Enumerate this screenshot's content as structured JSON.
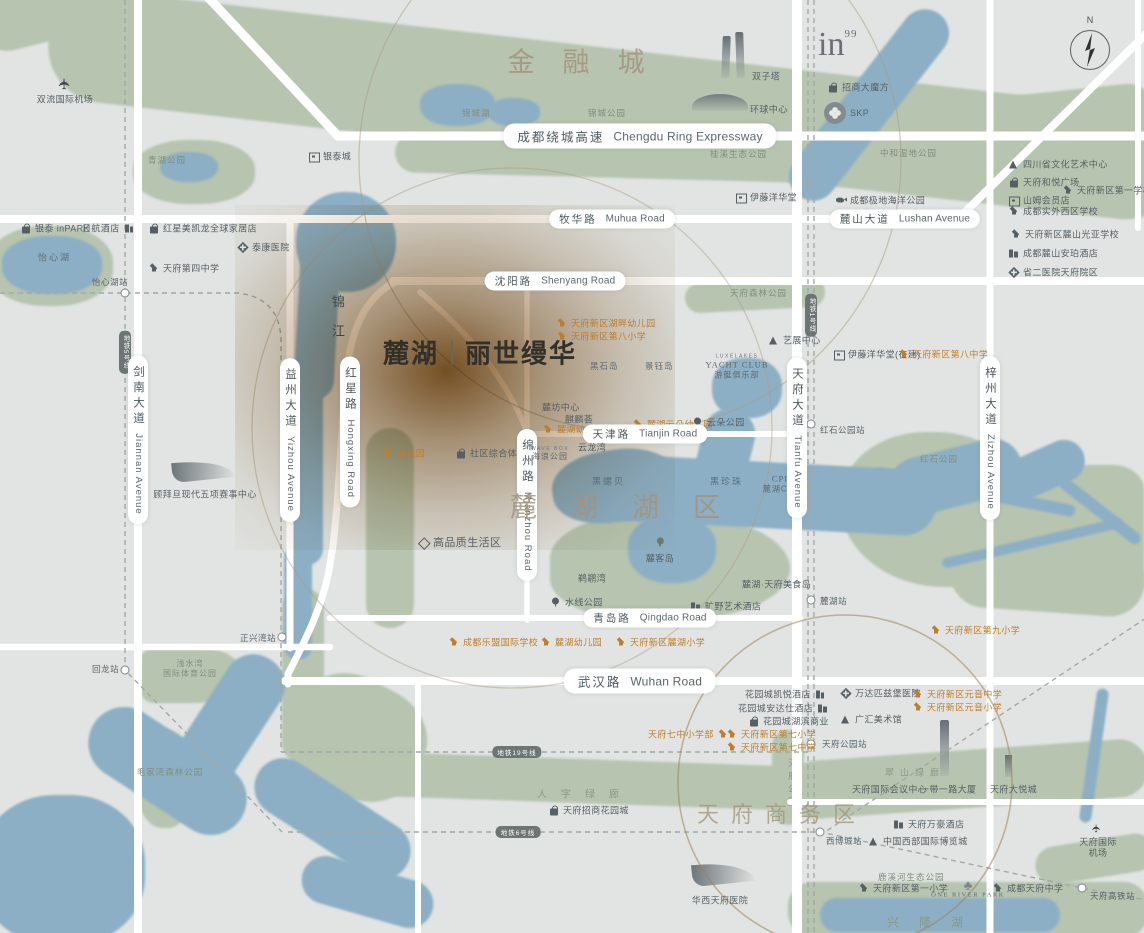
{
  "meta": {
    "description": "Stylized real-estate location map of Chengdu Tianfu New Area around LUXELAKES",
    "compass_n": "N",
    "colors": {
      "background": "#e1e4e2",
      "park_green": "#b6c4b0",
      "water_blue": "#8cafc5",
      "road_white": "#ffffff",
      "poi_gray": "#565f64",
      "poi_orange": "#bf7e2d",
      "title_brown": "#a5937e",
      "project_glow": "#7a4a1a"
    },
    "logos": {
      "in99": "in",
      "in99_sup": "99",
      "skp": "SKP"
    }
  },
  "project": {
    "name_left": "麓湖",
    "name_right": "丽世缦华"
  },
  "map": {
    "stations": [
      {
        "n": "station-yixinhu",
        "x": 125,
        "y": 293
      },
      {
        "n": "station-huilong",
        "x": 125,
        "y": 670
      },
      {
        "n": "station-zhengxingwan",
        "x": 282,
        "y": 637
      },
      {
        "n": "station-hongshipark",
        "x": 811,
        "y": 424
      },
      {
        "n": "station-luhu",
        "x": 811,
        "y": 600
      },
      {
        "n": "station-tianfupark",
        "x": 811,
        "y": 744
      },
      {
        "n": "station-xibocheng",
        "x": 820,
        "y": 832
      },
      {
        "n": "station-tianfu-hsr",
        "x": 1082,
        "y": 888
      }
    ],
    "labels": [
      {
        "n": "airport-shuangliu",
        "tp": "airport",
        "t": "双流国际机场",
        "x": 65,
        "y": 90
      },
      {
        "n": "park-qinghu",
        "tp": "park",
        "t": "青湖公园",
        "x": 148,
        "y": 160
      },
      {
        "n": "poi-yintai-city",
        "tp": "poi",
        "ic": "st",
        "t": "银泰城",
        "x": 308,
        "y": 156
      },
      {
        "n": "poi-yintai-inpark",
        "tp": "poi",
        "ic": "b",
        "t": "银泰 inPARK",
        "x": 20,
        "y": 228
      },
      {
        "n": "poi-hotel-nikko",
        "tp": "poi",
        "ic": "h",
        "ir": true,
        "t": "日航酒店",
        "x": 82,
        "y": 228
      },
      {
        "n": "poi-redstar-macalline",
        "tp": "poi",
        "ic": "b",
        "t": "红星美凯龙全球家居店",
        "x": 148,
        "y": 228
      },
      {
        "n": "poi-taikang-hospital",
        "tp": "poi",
        "ic": "c",
        "t": "泰康医院",
        "x": 237,
        "y": 247
      },
      {
        "n": "poi-tianfu-no4-school",
        "tp": "poi",
        "ic": "s",
        "t": "天府第四中学",
        "x": 148,
        "y": 268
      },
      {
        "n": "lake-yixinhu",
        "tp": "water",
        "t": "怡心湖",
        "x": 38,
        "y": 257
      },
      {
        "n": "stnl-yixinhu",
        "tp": "stn-l",
        "t": "怡心湖站",
        "x": 92,
        "y": 282
      },
      {
        "n": "district-financial-city",
        "tp": "title",
        "ctr": true,
        "sp": 28,
        "t": "金融城",
        "x": 590,
        "y": 60
      },
      {
        "n": "lake-jincheng",
        "tp": "park",
        "t": "锦城湖",
        "x": 462,
        "y": 113
      },
      {
        "n": "park-jincheng",
        "tp": "park",
        "t": "锦城公园",
        "x": 588,
        "y": 113
      },
      {
        "n": "poi-twin-towers",
        "tp": "poi",
        "t": "双子塔",
        "x": 752,
        "y": 76
      },
      {
        "n": "poi-global-center",
        "tp": "poi",
        "t": "环球中心",
        "x": 750,
        "y": 109
      },
      {
        "n": "road-ring-expressway",
        "tp": "pill-big",
        "ctr": true,
        "t": "成都绕城高速",
        "en": "Chengdu Ring Expressway",
        "x": 640,
        "y": 136
      },
      {
        "n": "park-guixi",
        "tp": "park",
        "t": "桂溪生态公园",
        "x": 710,
        "y": 154
      },
      {
        "n": "poi-ito-yokado",
        "tp": "poi",
        "ic": "st",
        "t": "伊藤洋华堂",
        "x": 735,
        "y": 197
      },
      {
        "n": "road-muhua",
        "tp": "pill",
        "ctr": true,
        "t": "牧华路",
        "en": "Muhua Road",
        "x": 612,
        "y": 219
      },
      {
        "n": "poi-cm-cube",
        "tp": "poi",
        "ic": "b",
        "t": "招商大魔方",
        "x": 827,
        "y": 87
      },
      {
        "n": "poi-skp",
        "tp": "poi",
        "t": "SKP",
        "x": 850,
        "y": 113
      },
      {
        "n": "park-zhonghe-wetland",
        "tp": "park",
        "t": "中和湿地公园",
        "x": 880,
        "y": 153
      },
      {
        "n": "poi-polar-ocean-park",
        "tp": "poi",
        "ic": "w",
        "t": "成都极地海洋公园",
        "x": 835,
        "y": 200
      },
      {
        "n": "road-lushan-ave",
        "tp": "pill",
        "ctr": true,
        "t": "麓山大道",
        "en": "Lushan Avenue",
        "x": 905,
        "y": 219
      },
      {
        "n": "poi-sichuan-art-center",
        "tp": "poi",
        "ic": "t",
        "t": "四川省文化艺术中心",
        "x": 1008,
        "y": 164
      },
      {
        "n": "poi-heyue-plaza",
        "tp": "poi",
        "ic": "b",
        "t": "天府和悦广场",
        "x": 1008,
        "y": 182
      },
      {
        "n": "poi-tianfu-no1-school",
        "tp": "poi",
        "ic": "s",
        "t": "天府新区第一学校",
        "x": 1062,
        "y": 190
      },
      {
        "n": "poi-sams-club",
        "tp": "poi",
        "ic": "st",
        "t": "山姆会员店",
        "x": 1008,
        "y": 200
      },
      {
        "n": "poi-shiwai-school",
        "tp": "poi",
        "ic": "s",
        "t": "成都实外西区学校",
        "x": 1008,
        "y": 211
      },
      {
        "n": "poi-guangya-school",
        "tp": "poi",
        "ic": "s",
        "t": "天府新区麓山光亚学校",
        "x": 1010,
        "y": 234
      },
      {
        "n": "poi-amber-hotel",
        "tp": "poi",
        "ic": "h",
        "t": "成都麓山安珀酒店",
        "x": 1008,
        "y": 253
      },
      {
        "n": "poi-prov-no2-hospital",
        "tp": "poi",
        "ic": "c",
        "t": "省二医院天府院区",
        "x": 1008,
        "y": 272
      },
      {
        "n": "road-shenyang",
        "tp": "pill",
        "ctr": true,
        "t": "沈阳路",
        "en": "Shenyang Road",
        "x": 555,
        "y": 281
      },
      {
        "n": "river-jinjiang",
        "tp": "water-v",
        "t": "锦江",
        "x": 328,
        "y": 295
      },
      {
        "n": "road-hongxing",
        "tp": "pill-v",
        "t": "红星路",
        "en": "Hongxing Road",
        "x": 350,
        "y": 432
      },
      {
        "n": "road-mianzhou",
        "tp": "pill-v",
        "t": "绵州路",
        "en": "Mianzhou Road",
        "x": 527,
        "y": 505
      },
      {
        "n": "poi-hupan-kindergarten",
        "tp": "poi-o",
        "ic": "s",
        "t": "天府新区湖畔幼儿园",
        "x": 556,
        "y": 323
      },
      {
        "n": "poi-no8-primary",
        "tp": "poi-o",
        "ic": "s",
        "t": "天府新区第八小学",
        "x": 556,
        "y": 336
      },
      {
        "n": "island-heishi",
        "tp": "island",
        "t": "黑石岛",
        "x": 590,
        "y": 366
      },
      {
        "n": "island-jingyu",
        "tp": "island",
        "t": "景钰岛",
        "x": 645,
        "y": 366
      },
      {
        "n": "blk-yacht-club",
        "tp": "blk",
        "lines": [
          [
            "l1",
            "LUXELAKES"
          ],
          [
            "l2",
            "YACHT CLUB"
          ],
          [
            "l3",
            "游艇俱乐部"
          ]
        ],
        "x": 737,
        "y": 367
      },
      {
        "n": "poi-art-expo-center",
        "tp": "poi",
        "ic": "t",
        "t": "艺展中心",
        "x": 768,
        "y": 340
      },
      {
        "n": "park-tianfu-forest",
        "tp": "park",
        "t": "天府森林公园",
        "x": 730,
        "y": 293
      },
      {
        "n": "poi-ito-yokado-uc",
        "tp": "poi",
        "ic": "st",
        "t": "伊藤洋华堂(在建)",
        "x": 833,
        "y": 354
      },
      {
        "n": "poi-no8-middle",
        "tp": "poi-o",
        "ic": "s",
        "t": "天府新区第八中学",
        "x": 898,
        "y": 354
      },
      {
        "n": "poi-lufang-center",
        "tp": "poi",
        "t": "麓坊中心",
        "x": 542,
        "y": 407
      },
      {
        "n": "poi-qilinhui",
        "tp": "poi",
        "t": "麒麟荟",
        "x": 565,
        "y": 419
      },
      {
        "n": "poi-yunduo-kindergarten",
        "tp": "poi-o",
        "ic": "s",
        "t": "麓湖云朵幼儿园",
        "x": 632,
        "y": 424
      },
      {
        "n": "poi-yunduo-park",
        "tp": "poi",
        "ic": "tr",
        "t": "云朵公园",
        "x": 692,
        "y": 422
      },
      {
        "n": "poi-luhu-kindergarten-n",
        "tp": "poi-o",
        "ic": "s",
        "t": "麓湖幼儿园(北区)",
        "x": 542,
        "y": 429
      },
      {
        "n": "road-tianjin",
        "tp": "pill",
        "ctr": true,
        "t": "天津路",
        "en": "Tianjin Road",
        "x": 645,
        "y": 434
      },
      {
        "n": "blk-wave-box",
        "tp": "blk",
        "lines": [
          [
            "l1",
            "WAVE BOX"
          ],
          [
            "l3",
            "海浪公园"
          ]
        ],
        "x": 550,
        "y": 454
      },
      {
        "n": "poi-yunlongwan",
        "tp": "poi",
        "t": "云龙湾",
        "x": 578,
        "y": 447
      },
      {
        "n": "poi-kindergarten-w",
        "tp": "poi-o",
        "ic": "s",
        "t": "幼儿园",
        "x": 382,
        "y": 453
      },
      {
        "n": "poi-community-complex",
        "tp": "poi",
        "ic": "b",
        "t": "社区综合体",
        "x": 455,
        "y": 453
      },
      {
        "n": "poi-quality-life-zone",
        "tp": "poi",
        "ic": "d",
        "fs": 11,
        "t": "高品质生活区",
        "x": 418,
        "y": 542
      },
      {
        "n": "district-luhu-lake",
        "tp": "title",
        "ctr": true,
        "sp": 34,
        "t": "麓湖湖区",
        "x": 632,
        "y": 505
      },
      {
        "n": "water-heiluobei",
        "tp": "water",
        "t": "黑螺贝",
        "x": 592,
        "y": 481
      },
      {
        "n": "water-heizhenzhu",
        "tp": "water",
        "t": "黑珍珠",
        "x": 710,
        "y": 481
      },
      {
        "n": "blk-cpi",
        "tp": "blk",
        "lines": [
          [
            "l2",
            "CPI"
          ],
          [
            "l3",
            "麓湖CPI"
          ]
        ],
        "x": 780,
        "y": 484
      },
      {
        "n": "blk-luke-island",
        "tp": "isle",
        "t": "麓客岛",
        "x": 660,
        "y": 549
      },
      {
        "n": "poi-tihuwan",
        "tp": "poi",
        "t": "鹈鹕湾",
        "x": 578,
        "y": 578
      },
      {
        "n": "poi-food-island",
        "tp": "poi",
        "t": "麓湖·天府美食岛",
        "x": 742,
        "y": 584
      },
      {
        "n": "poi-waterline-park",
        "tp": "poi",
        "ic": "tr",
        "t": "水线公园",
        "x": 550,
        "y": 602
      },
      {
        "n": "poi-kuangye-art-hotel",
        "tp": "poi",
        "ic": "h",
        "t": "旷野艺术酒店",
        "x": 690,
        "y": 606
      },
      {
        "n": "road-qingdao",
        "tp": "pill",
        "ctr": true,
        "t": "青岛路",
        "en": "Qingdao Road",
        "x": 650,
        "y": 618
      },
      {
        "n": "stnl-hongshipark",
        "tp": "stn-l",
        "t": "红石公园站",
        "x": 820,
        "y": 430
      },
      {
        "n": "park-hongshi",
        "tp": "park",
        "t": "红石公园",
        "x": 920,
        "y": 459
      },
      {
        "n": "road-tianfu-ave",
        "tp": "pill-v",
        "t": "天府大道",
        "en": "Tianfu Avenue",
        "x": 797,
        "y": 438
      },
      {
        "n": "road-zizhou-ave",
        "tp": "pill-v",
        "t": "梓州大道",
        "en": "Zizhou Avenue",
        "x": 990,
        "y": 438
      },
      {
        "n": "road-jiannan-ave",
        "tp": "pill-v",
        "t": "剑南大道",
        "en": "Jiannan Avenue",
        "x": 138,
        "y": 440
      },
      {
        "n": "road-yizhou-ave",
        "tp": "pill-v",
        "t": "益州大道",
        "en": "Yizhou Avenue",
        "x": 290,
        "y": 440
      },
      {
        "n": "venue-gubaidan",
        "tp": "venue",
        "t": "顾拜旦现代五项赛事中心",
        "x": 205,
        "y": 487
      },
      {
        "n": "stnl-zhengxingwan",
        "tp": "stn-l",
        "t": "正兴湾站",
        "x": 240,
        "y": 638
      },
      {
        "n": "stnl-huilong",
        "tp": "stn-l",
        "t": "回龙站",
        "x": 92,
        "y": 669
      },
      {
        "n": "blk-sports-park",
        "tp": "blk",
        "lines": [
          [
            "l3",
            "浅水湾"
          ],
          [
            "l3",
            "国际体育公园"
          ]
        ],
        "x": 190,
        "y": 669,
        "green": true
      },
      {
        "n": "park-maojiawan",
        "tp": "park",
        "ctr": true,
        "t": "毛家湾森林公园",
        "x": 170,
        "y": 772
      },
      {
        "n": "poi-lemeng-school",
        "tp": "poi-o",
        "ic": "s",
        "t": "成都乐盟国际学校",
        "x": 448,
        "y": 642
      },
      {
        "n": "poi-luhu-kindergarten",
        "tp": "poi-o",
        "ic": "s",
        "t": "麓湖幼儿园",
        "x": 540,
        "y": 642
      },
      {
        "n": "poi-luhu-primary",
        "tp": "poi-o",
        "ic": "s",
        "t": "天府新区麓湖小学",
        "x": 615,
        "y": 642
      },
      {
        "n": "stnl-luhu",
        "tp": "stn-l",
        "t": "麓湖站",
        "x": 820,
        "y": 601
      },
      {
        "n": "road-wuhan",
        "tp": "pill-big",
        "ctr": true,
        "t": "武汉路",
        "en": "Wuhan Road",
        "x": 640,
        "y": 681
      },
      {
        "n": "poi-no9-primary",
        "tp": "poi-o",
        "ic": "s",
        "t": "天府新区第九小学",
        "x": 930,
        "y": 630
      },
      {
        "n": "poi-hyatt-gardencity",
        "tp": "poi",
        "ic": "h",
        "ir": true,
        "t": "花园城凯悦酒店",
        "x": 745,
        "y": 694
      },
      {
        "n": "poi-andaz-gardencity",
        "tp": "poi",
        "ic": "h",
        "ir": true,
        "t": "花园城安达仕酒店",
        "x": 738,
        "y": 708
      },
      {
        "n": "poi-gardencity-biz",
        "tp": "poi",
        "ic": "b",
        "t": "花园城湖滨商业",
        "x": 748,
        "y": 721
      },
      {
        "n": "poi-tianfu7-primary-br",
        "tp": "poi-o",
        "ic": "s",
        "ir": true,
        "t": "天府七中小学部",
        "x": 648,
        "y": 734
      },
      {
        "n": "poi-no7-primary",
        "tp": "poi-o",
        "ic": "s",
        "t": "天府新区第七小学",
        "x": 726,
        "y": 734
      },
      {
        "n": "poi-no7-middle",
        "tp": "poi-o",
        "ic": "s",
        "t": "天府新区第七中学",
        "x": 726,
        "y": 747
      },
      {
        "n": "poi-wanda-hospital",
        "tp": "poi",
        "ic": "c",
        "t": "万达匹兹堡医院",
        "x": 840,
        "y": 693
      },
      {
        "n": "poi-yuanyin-middle",
        "tp": "poi-o",
        "ic": "s",
        "t": "天府新区元音中学",
        "x": 912,
        "y": 694
      },
      {
        "n": "poi-yuanyin-primary",
        "tp": "poi-o",
        "ic": "s",
        "t": "天府新区元音小学",
        "x": 912,
        "y": 707
      },
      {
        "n": "poi-guanghui-art",
        "tp": "poi",
        "ic": "t",
        "t": "广汇美术馆",
        "x": 840,
        "y": 719
      },
      {
        "n": "stnl-tianfupark",
        "tp": "stn-l",
        "t": "天府公园站",
        "x": 822,
        "y": 744
      },
      {
        "n": "corridor-renzi",
        "tp": "corridor",
        "ctr": true,
        "sp": 14,
        "t": "人字绿廊",
        "x": 585,
        "y": 793
      },
      {
        "n": "corridor-tianfu-park",
        "tp": "corridor-v",
        "t": "天府公园",
        "x": 786,
        "y": 758
      },
      {
        "n": "corridor-cuishan",
        "tp": "corridor",
        "ctr": true,
        "sp": 6,
        "fs": 9,
        "t": "翠山绿廊",
        "x": 915,
        "y": 772
      },
      {
        "n": "poi-intl-conference",
        "tp": "poi",
        "t": "天府国际会议中心",
        "x": 852,
        "y": 789
      },
      {
        "n": "poi-belt-road-tower",
        "tp": "poi",
        "t": "一带一路大厦",
        "x": 920,
        "y": 789
      },
      {
        "n": "poi-joycity",
        "tp": "poi",
        "t": "天府大悦城",
        "x": 990,
        "y": 789
      },
      {
        "n": "district-tianfu-cbd",
        "tp": "title2",
        "ctr": true,
        "sp": 12,
        "t": "天府商务区",
        "x": 782,
        "y": 813
      },
      {
        "n": "poi-cm-gardencity",
        "tp": "poi",
        "ic": "b",
        "t": "天府招商花园城",
        "x": 548,
        "y": 810
      },
      {
        "n": "poi-marriott",
        "tp": "poi",
        "ic": "h",
        "t": "天府万豪酒店",
        "x": 893,
        "y": 824
      },
      {
        "n": "stnl-xibocheng",
        "tp": "stn-l",
        "t": "西博城站",
        "x": 826,
        "y": 841
      },
      {
        "n": "poi-western-expo-city",
        "tp": "poi",
        "ic": "t",
        "t": "中国西部国际博览城",
        "x": 868,
        "y": 841
      },
      {
        "n": "park-luxihe",
        "tp": "park",
        "t": "鹿溪河生态公园",
        "x": 878,
        "y": 877
      },
      {
        "n": "poi-no1-primary",
        "tp": "poi",
        "ic": "s",
        "t": "天府新区第一小学",
        "x": 858,
        "y": 888
      },
      {
        "n": "blk-one-river-park",
        "tp": "orp",
        "t": "ONE RIVER PARK",
        "x": 968,
        "y": 889
      },
      {
        "n": "poi-tianfu-middle",
        "tp": "poi",
        "ic": "s",
        "t": "成都天府中学",
        "x": 992,
        "y": 888
      },
      {
        "n": "venue-huaxi-hospital",
        "tp": "venue",
        "t": "华西天府医院",
        "x": 720,
        "y": 893
      },
      {
        "n": "airport-tianfu",
        "tp": "airport",
        "t": "天府国际机场",
        "x": 1098,
        "y": 838
      },
      {
        "n": "stnl-tianfu-hsr",
        "tp": "stn-l",
        "t": "天府高铁站",
        "x": 1090,
        "y": 896
      },
      {
        "n": "lake-xinglong",
        "tp": "corridor",
        "ctr": true,
        "sp": 20,
        "fs": 12,
        "t": "兴隆湖",
        "x": 935,
        "y": 922
      }
    ],
    "metro_pills": [
      {
        "n": "metro-line5-pill",
        "t": "地铁5号线",
        "x": 125,
        "y": 352,
        "v": true
      },
      {
        "n": "metro-line1-pill",
        "t": "地铁1号线",
        "x": 811,
        "y": 315,
        "v": true
      },
      {
        "n": "metro-line19-pill",
        "t": "地铁19号线",
        "x": 517,
        "y": 752,
        "v": false
      },
      {
        "n": "metro-line6-pill",
        "t": "地铁6号线",
        "x": 518,
        "y": 832,
        "v": false
      }
    ]
  }
}
